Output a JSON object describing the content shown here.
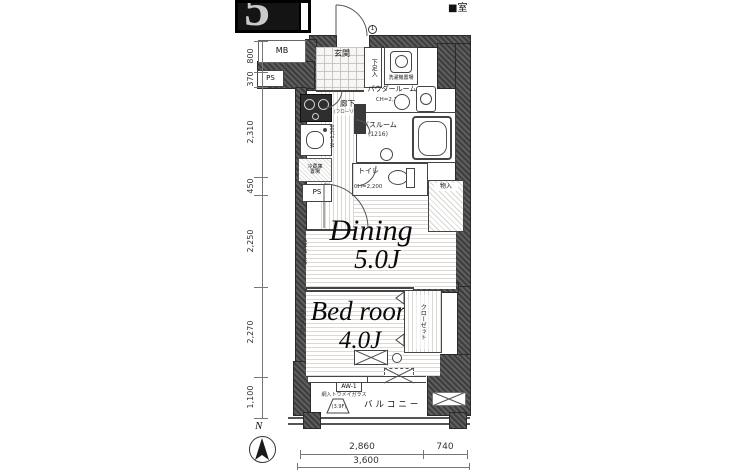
{
  "fragment": {
    "glyph": "5"
  },
  "legend": {
    "room_marker": "■室"
  },
  "compass": {
    "north": "N"
  },
  "door_number": "1",
  "labels": {
    "mb": "MB",
    "ps": "PS",
    "ps2": "PS",
    "entrance": "玄関",
    "shoe": "下足入",
    "washer": "洗濯機置場",
    "powder": "パウダールーム",
    "powder_ch": "CH=2,200",
    "bath": "バスルーム",
    "bath_size": "(1216)",
    "corridor": "廊下",
    "corridor_floor": "(フローリング)",
    "corridor_w": "W=1,500",
    "fridge_1": "冷蔵庫",
    "fridge_2": "置場",
    "toilet": "トイレ",
    "toilet_ch": "CH=2,200",
    "storage": "物入",
    "dining": "Dining",
    "dining_size": "5.0J",
    "dining_ch": "CH=2,450",
    "bedroom": "Bed room",
    "bedroom_size": "4.0J",
    "bedroom_ch": "CH=2,450",
    "closet": "クローゼット",
    "window_tag": "AW-1",
    "glass": "網入トウメイガラス",
    "balcony_floor": "(3.9F)",
    "balcony": "バルコニー"
  },
  "dimensions": {
    "left": [
      "800",
      "370",
      "2,310",
      "450",
      "2,250",
      "2,270",
      "1,100"
    ],
    "bottom_inner": [
      "2,860",
      "740"
    ],
    "bottom_total": "3,600"
  }
}
